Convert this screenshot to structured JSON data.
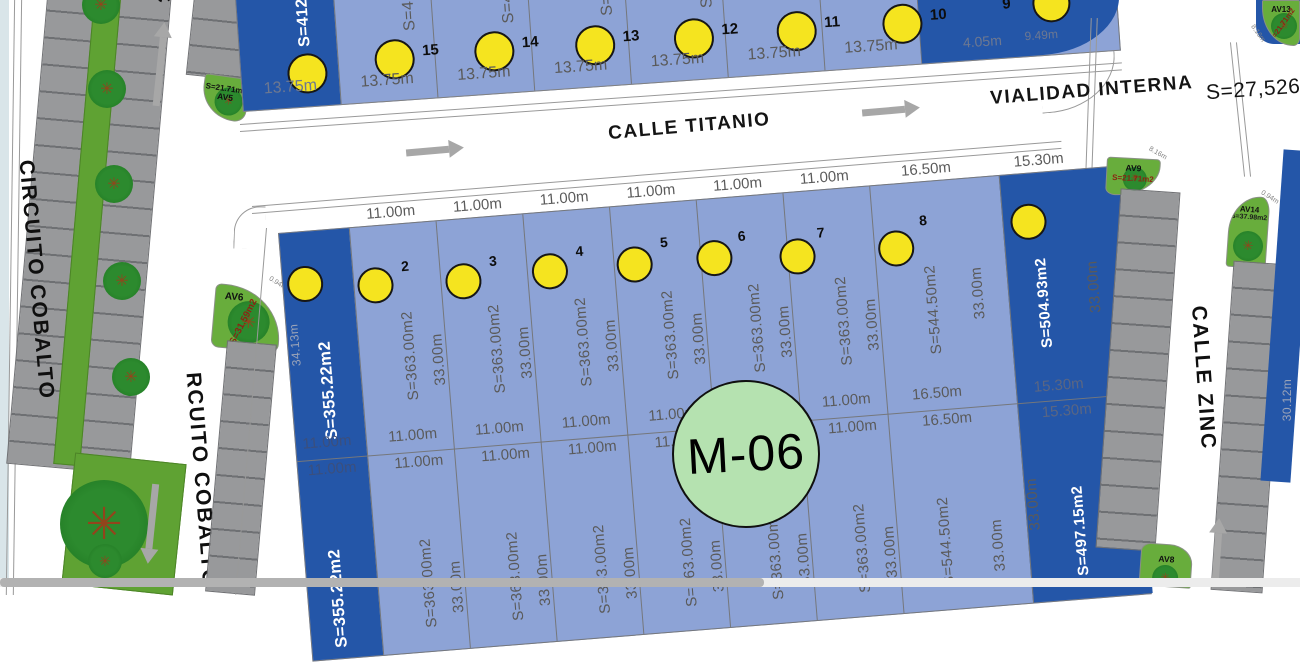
{
  "streets": {
    "circuito_cobalto": "CIRCUITO COBALTO",
    "circuito_cobalto_lower": "RCUITO COBALTO",
    "top_street_fragment": "C",
    "calle_titanio": "CALLE TITANIO",
    "vialidad_interna": "VIALIDAD INTERNA",
    "vialidad_interna_area": "S=27,526",
    "calle_zinc": "CALLE ZINC"
  },
  "block_badge": {
    "label": "M-06"
  },
  "top_row": {
    "first_lot": {
      "area_fragment": "S=412",
      "width": "13.75m"
    },
    "lots": [
      {
        "number": "15",
        "width": "13.75m",
        "area_fragment": "S=41"
      },
      {
        "number": "14",
        "width": "13.75m",
        "area_fragment": "S=4"
      },
      {
        "number": "13",
        "width": "13.75m",
        "area_fragment": "S="
      },
      {
        "number": "12",
        "width": "13.75m",
        "area_fragment": "S"
      },
      {
        "number": "11",
        "width": "13.75m",
        "area_fragment": ""
      },
      {
        "number": "10",
        "width": "13.75m",
        "area_fragment": ""
      }
    ],
    "lot9": {
      "number": "9",
      "edge_label_1": "4.05m",
      "edge_label_2": "9.49m"
    }
  },
  "m06": {
    "lot1": {
      "area": "S=355.22m2",
      "side": "34.13m",
      "mid_top": "11.00m",
      "mid_bottom": "11.00m"
    },
    "upper_lots": [
      {
        "number": "2",
        "width": "11.00m",
        "area": "S=363.00m2",
        "depth": "33.00m",
        "mid_top": "11.00m",
        "mid_bottom": "11.00m"
      },
      {
        "number": "3",
        "width": "11.00m",
        "area": "S=363.00m2",
        "depth": "33.00m",
        "mid_top": "11.00m",
        "mid_bottom": "11.00m"
      },
      {
        "number": "4",
        "width": "11.00m",
        "area": "S=363.00m2",
        "depth": "33.00m",
        "mid_top": "11.00m",
        "mid_bottom": "11.00m"
      },
      {
        "number": "5",
        "width": "11.00m",
        "area": "S=363.00m2",
        "depth": "33.00m",
        "mid_top": "11.00m",
        "mid_bottom": "11.00m"
      },
      {
        "number": "6",
        "width": "11.00m",
        "area": "S=363.00m2",
        "depth": "33.00m",
        "mid_top": "11.00m",
        "mid_bottom": "11.00m"
      },
      {
        "number": "7",
        "width": "11.00m",
        "area": "S=363.00m2",
        "depth": "33.00m",
        "mid_top": "11.00m",
        "mid_bottom": "11.00m"
      },
      {
        "number": "8",
        "width": "16.50m",
        "area": "S=544.50m2",
        "depth": "33.00m",
        "mid_top": "16.50m",
        "mid_bottom": "16.50m"
      }
    ],
    "corner": {
      "width": "15.30m",
      "area": "S=504.93m2",
      "depth": "33.00m",
      "mid_top": "15.30m",
      "mid_bottom": "15.30m"
    },
    "lower_lots": [
      {
        "area": "S=363.00m2",
        "depth": "33.00m"
      },
      {
        "area": "S=363.00m2",
        "depth": "33.00m"
      },
      {
        "area": "S=363.00m2",
        "depth": "33.00m"
      },
      {
        "area": "S=363.00m2",
        "depth": "33.00m"
      },
      {
        "area": "S=363.00m2",
        "depth": "33.00m"
      },
      {
        "area": "S=363.00m2",
        "depth": "33.00m"
      },
      {
        "area": "S=544.50m2",
        "depth": "33.00m"
      }
    ],
    "lower_corner": {
      "area": "S=497.15m2",
      "depth": "33.00m",
      "side": "10.11m"
    },
    "lower_lot1_area": "S=355.22m2"
  },
  "green_areas": {
    "av5": {
      "id": "AV5",
      "area": "S=21.71m2",
      "edge": "0.94m"
    },
    "av6": {
      "id": "AV6",
      "area": "S=31.59m2",
      "edge": "0.94m"
    },
    "av8": {
      "id": "AV8"
    },
    "av9": {
      "id": "AV9",
      "area": "S=21.71m2",
      "edge": "8.16m"
    },
    "av13": {
      "id": "AV13",
      "area": "S=21.71m2",
      "edge": "8.16m"
    },
    "av14": {
      "id": "AV14",
      "area": "S=37.98m2",
      "edge": "0.94m"
    }
  },
  "right_edge": {
    "lot_side": "30.12m"
  }
}
